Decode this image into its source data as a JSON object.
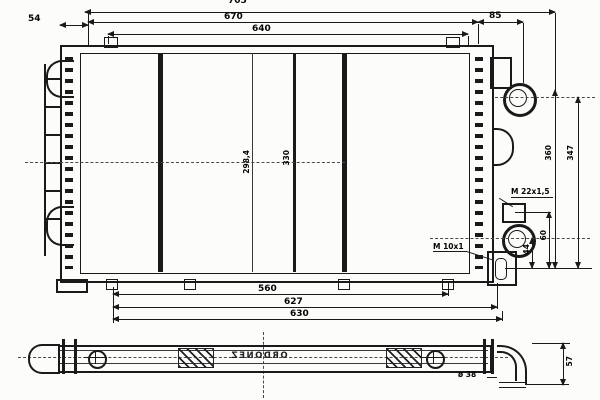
{
  "drawing": {
    "subject": "radiator-technical-drawing",
    "views": 2
  },
  "dims": {
    "top_overall": "705",
    "top_670": "670",
    "top_640": "640",
    "left_54": "54",
    "right_85": "85",
    "core_a": "298,4",
    "core_b": "330",
    "right_360": "360",
    "right_347": "347",
    "right_60": "60",
    "right_44": "44",
    "bottom_560": "560",
    "bottom_627": "627",
    "bottom_630": "630",
    "thread_m22": "M 22x1,5",
    "thread_m10": "M 10x1",
    "outlet_dia": "ø 38",
    "elbow_57": "57"
  },
  "watermark": "ORDONEZ"
}
